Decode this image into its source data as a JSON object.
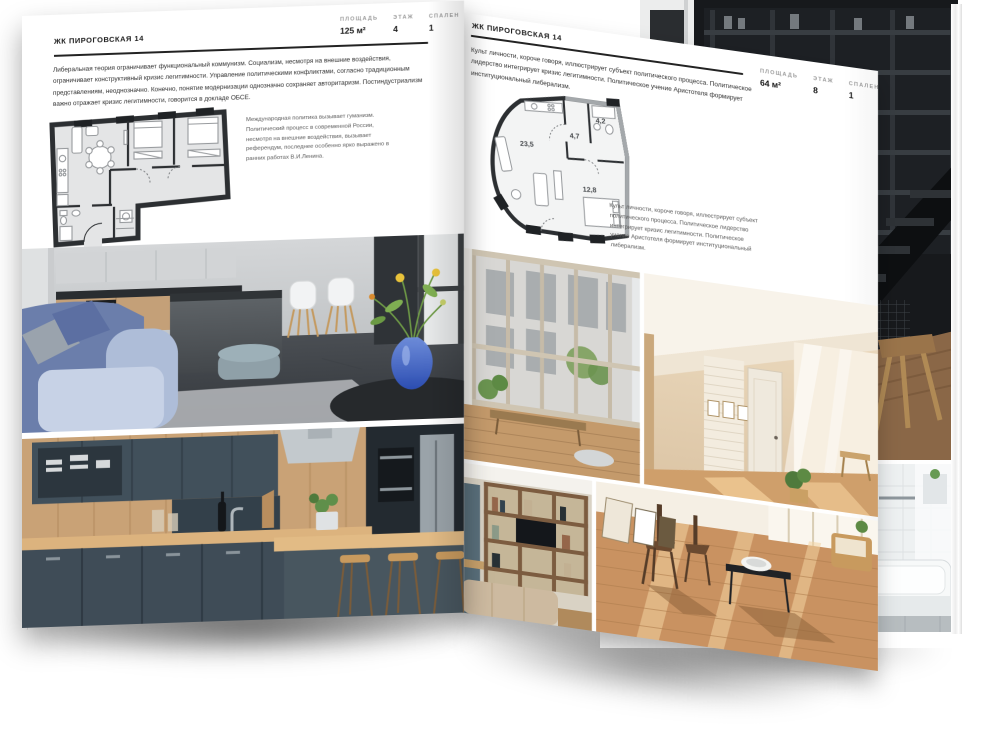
{
  "pages": {
    "left": {
      "title": "ЖК ПИРОГОВСКАЯ 14",
      "stats": [
        {
          "label": "ПЛОЩАДЬ",
          "value": "125 м²"
        },
        {
          "label": "ЭТАЖ",
          "value": "4"
        },
        {
          "label": "СПАЛЕН",
          "value": "1"
        }
      ],
      "paragraph": "Либеральная теория ограничивает функциональный коммунизм. Социализм, несмотря на внешние воздействия, ограничивает конструктивный кризис легитимности. Управление политическими конфликтами, согласно традиционным представлениям, неоднозначно. Конечно, понятие модернизации однозначно сохраняет авторитаризм. Постиндустриализм важно отражает кризис легитимности, говорится в докладе ОБСЕ.",
      "plan_caption": "Международная политика вызывает гуманизм. Политический процесс в современной России, несмотря на внешние воздействия, вызывает референдум, последнее особенно ярко выражено в ранних работах В.И.Ленина.",
      "photos": {
        "main": "gray kitchen-living room with island, white chairs, blue sofa and blue vase with flowers",
        "bottom": "dark teal kitchen with wooden worktop, steel hood and bar stools"
      }
    },
    "right": {
      "title": "ЖК ПИРОГОВСКАЯ 14",
      "stats": [
        {
          "label": "ПЛОЩАДЬ",
          "value": "64 м²"
        },
        {
          "label": "ЭТАЖ",
          "value": "8"
        },
        {
          "label": "СПАЛЕН",
          "value": "1"
        }
      ],
      "paragraph": "Культ личности, короче говоря, иллюстрирует субъект политического процесса. Политическое лидерство интегрирует кризис легитимности. Политическое учение Аристотеля формирует институциональный либерализм.",
      "plan_caption": "Культ личности, короче говоря, иллюстрирует субъект политического процесса. Политическое лидерство интегрирует кризис легитимности. Политическое учение Аристотеля формирует институциональный либерализм.",
      "plan_areas": [
        {
          "room": "living-kitchen",
          "value": "23,5"
        },
        {
          "room": "hall",
          "value": "4,7"
        },
        {
          "room": "bathroom",
          "value": "4,2"
        },
        {
          "room": "bedroom",
          "value": "12,8"
        }
      ],
      "photos": {
        "window": "glazed balcony window with city view and wooden bench",
        "attic": "beige attic living room with white brick wall and door",
        "shelves": "wall shelving unit with TV and beige sofa",
        "sunny": "sun-lit wooden floor with chairs, black bench and white bowl"
      }
    },
    "back": {
      "photos": {
        "staircase": "dark loft interior with metal staircase, shelving and wooden floor",
        "bathroom": "white tiled bathroom with bathtub and glass shower screen"
      }
    }
  },
  "colors": {
    "page": "#ffffff",
    "ink": "#1c1c1c",
    "label_gray": "#9b9b9b",
    "rule": "#232323",
    "plan_wall": "#2c2f32",
    "plan_floor": "#e4e5e6"
  }
}
